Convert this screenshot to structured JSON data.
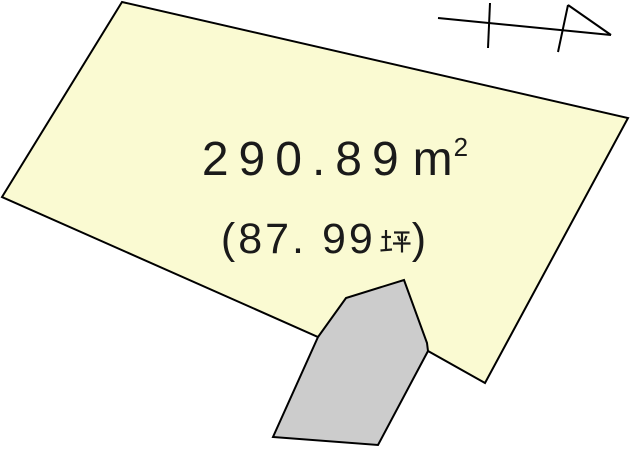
{
  "diagram": {
    "kind": "land-plot-diagram",
    "parcel": {
      "area_label": {
        "full": "290.89㎡",
        "value": "290.89",
        "unit_base": "m",
        "unit_exponent": "2"
      },
      "tsubo_label": {
        "full": "(87.99坪)",
        "open": "(",
        "number": "87. 99",
        "unit": "坪",
        "close": ")"
      }
    },
    "icons": {
      "north_arrow": "north-arrow-icon",
      "tsubo_kanji": "tsubo-kanji-glyph"
    },
    "colors": {
      "parcel_fill": "#fafad2",
      "adjacent_fill": "#cccccc",
      "outline": "#000000",
      "canvas": "#ffffff",
      "text": "#1a1a1a"
    }
  }
}
